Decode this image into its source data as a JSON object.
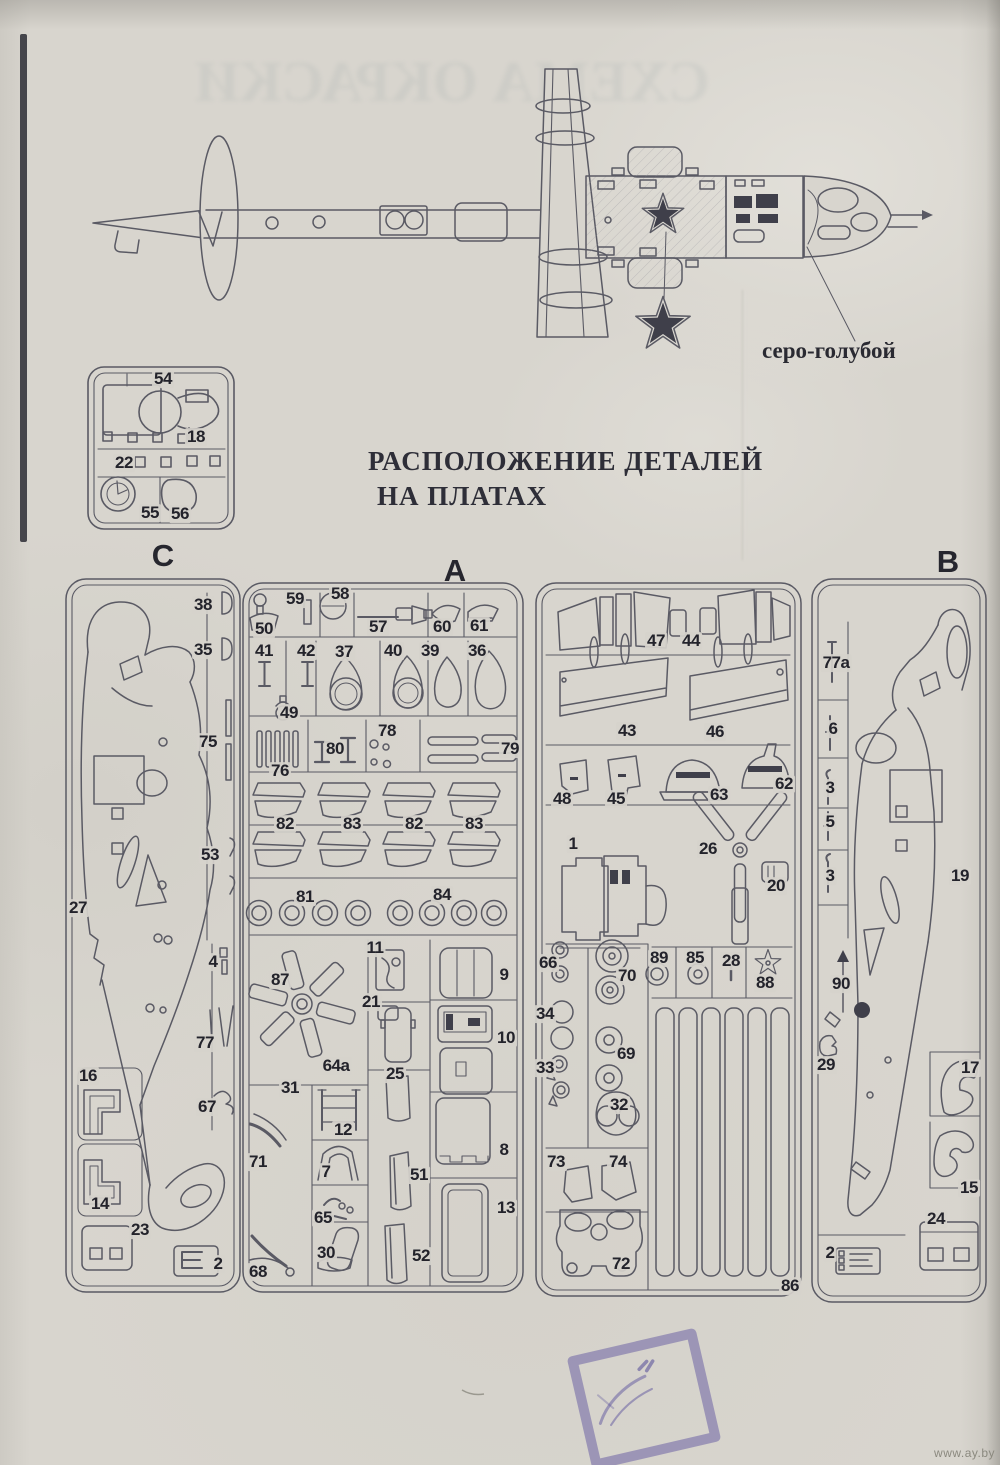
{
  "page": {
    "ghost_text": "СХЕМА ОКРАСКИ",
    "title_line1": "РАСПОЛОЖЕНИЕ ДЕТАЛЕЙ",
    "title_line2": "НА ПЛАТАХ",
    "color_callout": "серо-голубой",
    "watermark": "www.ay.by"
  },
  "colors": {
    "paper": "#d6d3cc",
    "ink": "#5a5a64",
    "label_ink": "#23232b",
    "star_fill": "#3f3f4a",
    "stamp": "#5c529e"
  },
  "sprues": {
    "small": {
      "labels": [
        {
          "t": "54",
          "x": 163,
          "y": 379
        },
        {
          "t": "18",
          "x": 196,
          "y": 437
        },
        {
          "t": "22",
          "x": 124,
          "y": 463
        },
        {
          "t": "55",
          "x": 150,
          "y": 513
        },
        {
          "t": "56",
          "x": 180,
          "y": 514
        }
      ]
    },
    "c": {
      "header": "C",
      "labels": [
        {
          "t": "38",
          "x": 203,
          "y": 605
        },
        {
          "t": "35",
          "x": 203,
          "y": 650
        },
        {
          "t": "75",
          "x": 208,
          "y": 742
        },
        {
          "t": "53",
          "x": 210,
          "y": 855
        },
        {
          "t": "27",
          "x": 78,
          "y": 908
        },
        {
          "t": "4",
          "x": 213,
          "y": 962
        },
        {
          "t": "77",
          "x": 205,
          "y": 1043
        },
        {
          "t": "67",
          "x": 207,
          "y": 1107
        },
        {
          "t": "16",
          "x": 88,
          "y": 1076
        },
        {
          "t": "14",
          "x": 100,
          "y": 1204
        },
        {
          "t": "23",
          "x": 140,
          "y": 1230
        },
        {
          "t": "2",
          "x": 218,
          "y": 1264
        }
      ]
    },
    "a": {
      "header": "A",
      "labels": [
        {
          "t": "59",
          "x": 295,
          "y": 599
        },
        {
          "t": "50",
          "x": 264,
          "y": 629
        },
        {
          "t": "58",
          "x": 340,
          "y": 594
        },
        {
          "t": "57",
          "x": 378,
          "y": 627
        },
        {
          "t": "60",
          "x": 442,
          "y": 627
        },
        {
          "t": "61",
          "x": 479,
          "y": 626
        },
        {
          "t": "41",
          "x": 264,
          "y": 651
        },
        {
          "t": "42",
          "x": 306,
          "y": 651
        },
        {
          "t": "37",
          "x": 344,
          "y": 652
        },
        {
          "t": "40",
          "x": 393,
          "y": 651
        },
        {
          "t": "39",
          "x": 430,
          "y": 651
        },
        {
          "t": "36",
          "x": 477,
          "y": 651
        },
        {
          "t": "49",
          "x": 289,
          "y": 713
        },
        {
          "t": "76",
          "x": 280,
          "y": 771
        },
        {
          "t": "80",
          "x": 335,
          "y": 749
        },
        {
          "t": "78",
          "x": 387,
          "y": 731
        },
        {
          "t": "79",
          "x": 510,
          "y": 749
        },
        {
          "t": "82",
          "x": 285,
          "y": 824
        },
        {
          "t": "83",
          "x": 352,
          "y": 824
        },
        {
          "t": "82",
          "x": 414,
          "y": 824
        },
        {
          "t": "83",
          "x": 474,
          "y": 824
        },
        {
          "t": "81",
          "x": 305,
          "y": 897
        },
        {
          "t": "84",
          "x": 442,
          "y": 895
        },
        {
          "t": "87",
          "x": 280,
          "y": 980
        },
        {
          "t": "11",
          "x": 375,
          "y": 948
        },
        {
          "t": "21",
          "x": 371,
          "y": 1002
        },
        {
          "t": "9",
          "x": 504,
          "y": 975
        },
        {
          "t": "10",
          "x": 506,
          "y": 1038
        },
        {
          "t": "64a",
          "x": 336,
          "y": 1066
        },
        {
          "t": "25",
          "x": 395,
          "y": 1074
        },
        {
          "t": "31",
          "x": 290,
          "y": 1088
        },
        {
          "t": "12",
          "x": 343,
          "y": 1130
        },
        {
          "t": "7",
          "x": 326,
          "y": 1172
        },
        {
          "t": "65",
          "x": 323,
          "y": 1218
        },
        {
          "t": "30",
          "x": 326,
          "y": 1253
        },
        {
          "t": "71",
          "x": 258,
          "y": 1162
        },
        {
          "t": "68",
          "x": 258,
          "y": 1272
        },
        {
          "t": "51",
          "x": 419,
          "y": 1175
        },
        {
          "t": "52",
          "x": 421,
          "y": 1256
        },
        {
          "t": "8",
          "x": 504,
          "y": 1150
        },
        {
          "t": "13",
          "x": 506,
          "y": 1208
        }
      ]
    },
    "middle": {
      "labels": [
        {
          "t": "47",
          "x": 656,
          "y": 641
        },
        {
          "t": "44",
          "x": 691,
          "y": 641
        },
        {
          "t": "43",
          "x": 627,
          "y": 731
        },
        {
          "t": "46",
          "x": 715,
          "y": 732
        },
        {
          "t": "48",
          "x": 562,
          "y": 799
        },
        {
          "t": "45",
          "x": 616,
          "y": 799
        },
        {
          "t": "63",
          "x": 719,
          "y": 795
        },
        {
          "t": "62",
          "x": 784,
          "y": 784
        },
        {
          "t": "1",
          "x": 573,
          "y": 844
        },
        {
          "t": "26",
          "x": 708,
          "y": 849
        },
        {
          "t": "20",
          "x": 776,
          "y": 886
        },
        {
          "t": "66",
          "x": 548,
          "y": 963
        },
        {
          "t": "70",
          "x": 627,
          "y": 976
        },
        {
          "t": "34",
          "x": 545,
          "y": 1014
        },
        {
          "t": "33",
          "x": 545,
          "y": 1068
        },
        {
          "t": "69",
          "x": 626,
          "y": 1054
        },
        {
          "t": "32",
          "x": 619,
          "y": 1105
        },
        {
          "t": "73",
          "x": 556,
          "y": 1162
        },
        {
          "t": "74",
          "x": 618,
          "y": 1162
        },
        {
          "t": "89",
          "x": 659,
          "y": 958
        },
        {
          "t": "85",
          "x": 695,
          "y": 958
        },
        {
          "t": "28",
          "x": 731,
          "y": 961
        },
        {
          "t": "88",
          "x": 765,
          "y": 983
        },
        {
          "t": "72",
          "x": 621,
          "y": 1264
        },
        {
          "t": "86",
          "x": 790,
          "y": 1286
        }
      ]
    },
    "b": {
      "header": "B",
      "labels": [
        {
          "t": "77a",
          "x": 836,
          "y": 663
        },
        {
          "t": "6",
          "x": 833,
          "y": 729
        },
        {
          "t": "3",
          "x": 830,
          "y": 788
        },
        {
          "t": "5",
          "x": 830,
          "y": 822
        },
        {
          "t": "3",
          "x": 830,
          "y": 876
        },
        {
          "t": "19",
          "x": 960,
          "y": 876
        },
        {
          "t": "90",
          "x": 841,
          "y": 984
        },
        {
          "t": "29",
          "x": 826,
          "y": 1065
        },
        {
          "t": "17",
          "x": 970,
          "y": 1068
        },
        {
          "t": "15",
          "x": 969,
          "y": 1188
        },
        {
          "t": "24",
          "x": 936,
          "y": 1219
        },
        {
          "t": "2",
          "x": 830,
          "y": 1253
        }
      ]
    }
  }
}
